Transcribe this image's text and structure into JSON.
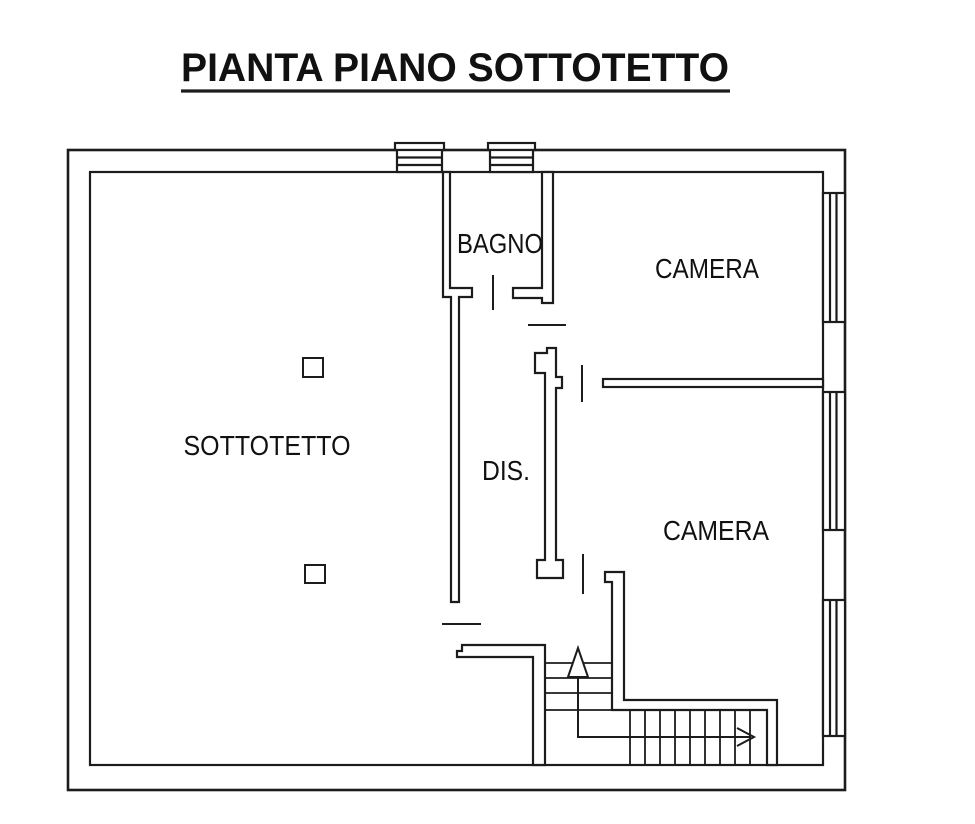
{
  "title": "PIANTA PIANO SOTTOTETTO",
  "rooms": {
    "sottotetto": "SOTTOTETTO",
    "bagno": "BAGNO",
    "camera_top": "CAMERA",
    "camera_bottom": "CAMERA",
    "disimpegno": "DIS."
  },
  "icons": {
    "stairs_up_arrow": "triangle-up-outline",
    "stairs_run_arrow": "open-arrow-right"
  },
  "colors": {
    "line": "#1c1c1c",
    "text": "#111111",
    "background": "#ffffff"
  }
}
